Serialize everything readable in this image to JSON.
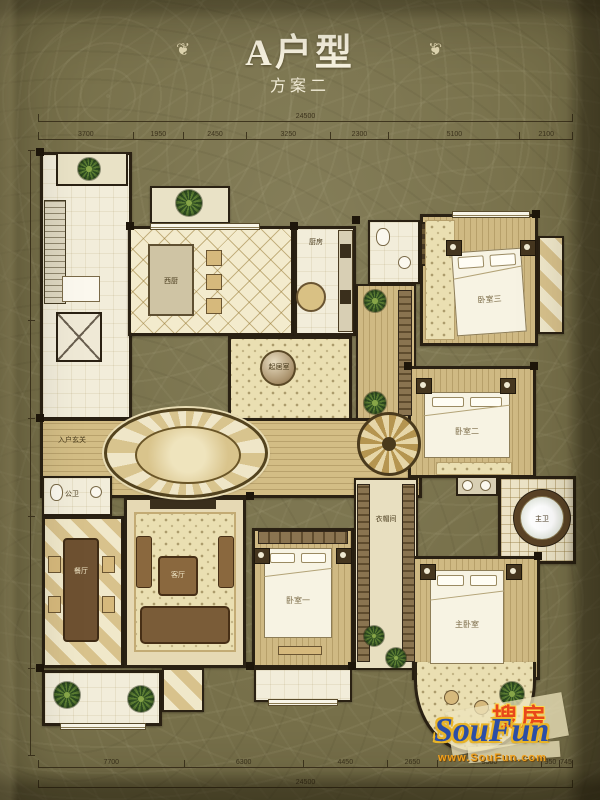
{
  "header": {
    "title": "A户型",
    "subtitle": "方案二",
    "ornament": "❦"
  },
  "dimensions": {
    "top_overall": "24500",
    "top_segments": [
      "3700",
      "1950",
      "2450",
      "3250",
      "2300",
      "5100",
      "2100"
    ],
    "bottom_segments": [
      "7700",
      "6300",
      "4450",
      "2650",
      "5500",
      "950",
      "745"
    ],
    "bottom_overall": "24500"
  },
  "rooms": {
    "entry_hall": "入户玄关",
    "west_kitchen": "西厨",
    "kitchen": "厨房",
    "family_room": "起居室",
    "guest_bath": "公卫",
    "dining_room": "餐厅",
    "living_room": "客厅",
    "bedroom_1": "卧室一",
    "bedroom_2": "卧室二",
    "bedroom_3": "卧室三",
    "master_bedroom": "主卧室",
    "master_bath": "主卫",
    "closet": "衣帽间"
  },
  "watermark": {
    "cn": "搜房",
    "en": "SouFun",
    "url": "www.SouFun.com"
  },
  "colors": {
    "background": "#77704a",
    "wall": "#2a2113",
    "floor_cream": "#f2edda",
    "tile_tan": "#d9c58c",
    "wood": "#cfb983",
    "carpet": "#eadfb2",
    "dim_line": "#3f361f",
    "title_text": "#f8f3e0",
    "logo_blue": "#2b4ea6",
    "logo_red": "#e8481a",
    "logo_gold": "#f0a01c"
  }
}
